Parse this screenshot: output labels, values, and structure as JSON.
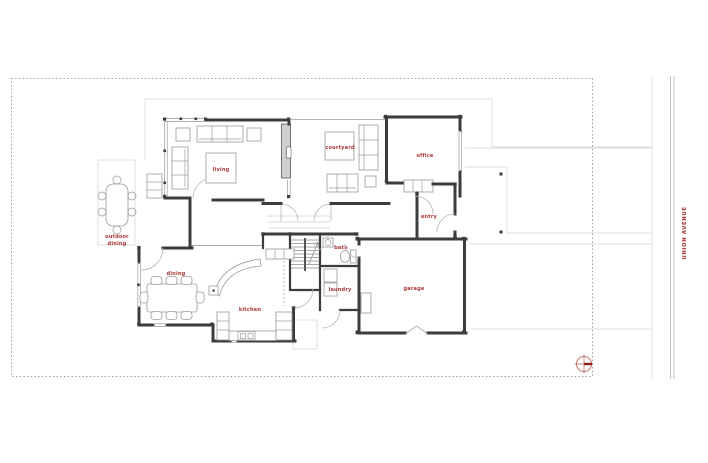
{
  "drawing": {
    "kind": "residential floor plan",
    "street": {
      "name": "UNION AVENUE"
    },
    "rooms": {
      "living": "living",
      "courtyard": "courtyard",
      "office": "office",
      "entry": "entry",
      "bath": "bath",
      "laundry": "laundry",
      "garage": "garage",
      "dining": "dining",
      "kitchen": "kitchen",
      "outdoor_dining_line1": "outdoor",
      "outdoor_dining_line2": "dining"
    },
    "symbols": {
      "north_marker": "north-arrow-icon"
    },
    "colors": {
      "label_red": "#a93434",
      "wall_dark": "#3c3c3c",
      "guide_gray": "#dcdcdc",
      "property_gray": "#9f9f9f",
      "compass_red": "#c46a6a",
      "compass_dark_red": "#8e1f1f"
    }
  }
}
